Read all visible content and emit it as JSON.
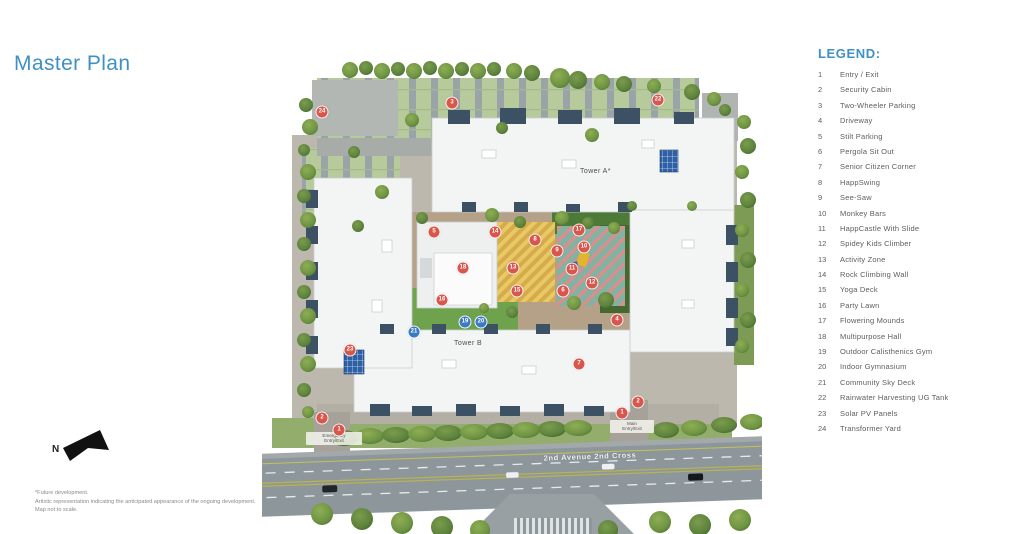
{
  "page": {
    "title": "Master Plan",
    "accent_color": "#3f90c5"
  },
  "compass": {
    "label": "N"
  },
  "disclaimer": {
    "line1": "*Future development.",
    "line2": "Artistic representation indicating the anticipated appearance of the ongoing development.",
    "line3": "Map not to scale."
  },
  "legend": {
    "title": "LEGEND:",
    "items": [
      {
        "num": "1",
        "label": "Entry / Exit"
      },
      {
        "num": "2",
        "label": "Security Cabin"
      },
      {
        "num": "3",
        "label": "Two-Wheeler Parking"
      },
      {
        "num": "4",
        "label": "Driveway"
      },
      {
        "num": "5",
        "label": "Stilt Parking"
      },
      {
        "num": "6",
        "label": "Pergola Sit Out"
      },
      {
        "num": "7",
        "label": "Senior Citizen Corner"
      },
      {
        "num": "8",
        "label": "HappSwing"
      },
      {
        "num": "9",
        "label": "See-Saw"
      },
      {
        "num": "10",
        "label": "Monkey Bars"
      },
      {
        "num": "11",
        "label": "HappCastle With Slide"
      },
      {
        "num": "12",
        "label": "Spidey Kids Climber"
      },
      {
        "num": "13",
        "label": "Activity Zone"
      },
      {
        "num": "14",
        "label": "Rock Climbing Wall"
      },
      {
        "num": "15",
        "label": "Yoga Deck"
      },
      {
        "num": "16",
        "label": "Party Lawn"
      },
      {
        "num": "17",
        "label": "Flowering Mounds"
      },
      {
        "num": "18",
        "label": "Multipurpose Hall"
      },
      {
        "num": "19",
        "label": "Outdoor Calisthenics Gym"
      },
      {
        "num": "20",
        "label": "Indoor Gymnasium"
      },
      {
        "num": "21",
        "label": "Community Sky Deck"
      },
      {
        "num": "22",
        "label": "Rainwater Harvesting UG Tank"
      },
      {
        "num": "23",
        "label": "Solar PV Panels"
      },
      {
        "num": "24",
        "label": "Transformer Yard"
      }
    ]
  },
  "map": {
    "labels": {
      "tower_a": "Tower A*",
      "tower_b": "Tower B",
      "emergency_entry": "Emergency\nEntry/Exit",
      "main_entry": "Main\nEntry/Exit",
      "road": "2nd Avenue 2nd Cross"
    },
    "marker_colors": {
      "red": "#d9564c",
      "blue": "#3a79c3"
    },
    "markers": [
      {
        "num": "24",
        "x": 60,
        "y": 112
      },
      {
        "num": "3",
        "x": 190,
        "y": 103
      },
      {
        "num": "22",
        "x": 396,
        "y": 100
      },
      {
        "num": "5",
        "x": 172,
        "y": 232
      },
      {
        "num": "14",
        "x": 233,
        "y": 232
      },
      {
        "num": "17",
        "x": 317,
        "y": 230
      },
      {
        "num": "8",
        "x": 273,
        "y": 240
      },
      {
        "num": "9",
        "x": 295,
        "y": 251
      },
      {
        "num": "10",
        "x": 322,
        "y": 247
      },
      {
        "num": "11",
        "x": 310,
        "y": 269
      },
      {
        "num": "12",
        "x": 330,
        "y": 283
      },
      {
        "num": "13",
        "x": 251,
        "y": 268
      },
      {
        "num": "18",
        "x": 201,
        "y": 268
      },
      {
        "num": "15",
        "x": 255,
        "y": 291
      },
      {
        "num": "16",
        "x": 180,
        "y": 300
      },
      {
        "num": "6",
        "x": 301,
        "y": 291
      },
      {
        "num": "4",
        "x": 355,
        "y": 320
      },
      {
        "num": "7",
        "x": 317,
        "y": 364
      },
      {
        "num": "23",
        "x": 88,
        "y": 350
      },
      {
        "num": "2",
        "x": 60,
        "y": 418
      },
      {
        "num": "1",
        "x": 77,
        "y": 430
      },
      {
        "num": "2",
        "x": 376,
        "y": 402
      },
      {
        "num": "1",
        "x": 360,
        "y": 413
      },
      {
        "num": "19",
        "x": 203,
        "y": 322,
        "color": "blue"
      },
      {
        "num": "20",
        "x": 219,
        "y": 322,
        "color": "blue"
      },
      {
        "num": "21",
        "x": 152,
        "y": 332,
        "color": "blue"
      }
    ]
  }
}
